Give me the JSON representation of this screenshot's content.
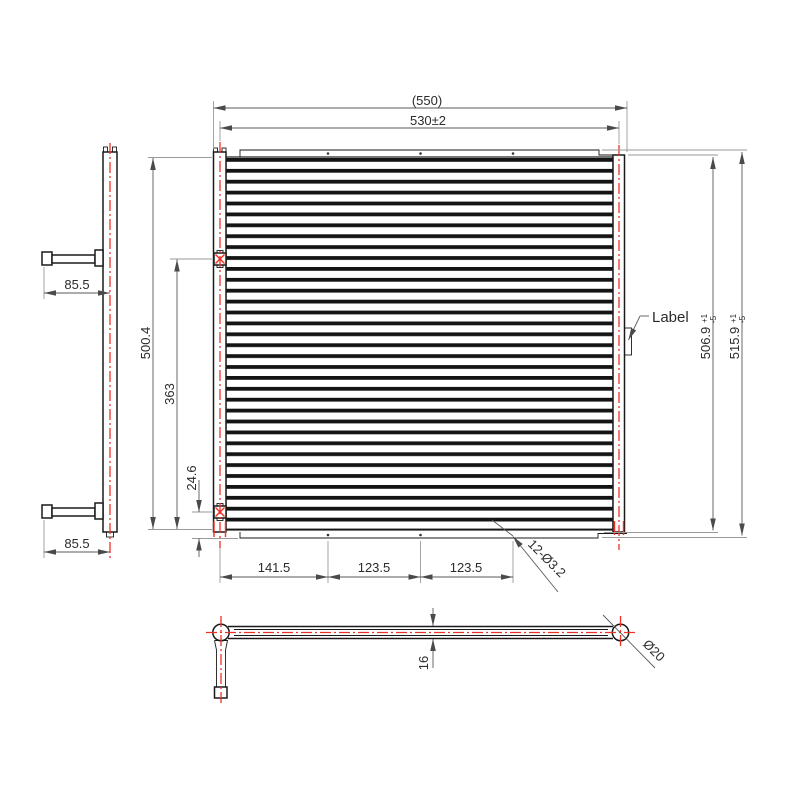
{
  "drawing": {
    "type": "engineering-drawing",
    "subject": "micro-channel condenser coil, three orthographic views",
    "colors": {
      "background": "#ffffff",
      "object_line": "#1a1a1a",
      "dimension_line": "#5a5a5a",
      "extension_line": "#9a9a9a",
      "centerline_red": "#ef3125",
      "text": "#2b2b2b"
    }
  },
  "labels": {
    "overall_width": "(550)",
    "core_width": "530±2",
    "overall_height": "500.4",
    "port_span": "363",
    "port_offset": "24.6",
    "pipe_top": "85.5",
    "pipe_bottom": "85.5",
    "label_callout": "Label",
    "height_inner": {
      "value": "506.9",
      "tol_up": "+1",
      "tol_dn": "-5"
    },
    "height_outer": {
      "value": "515.9",
      "tol_up": "+1",
      "tol_dn": "-5"
    },
    "chain": [
      "141.5",
      "123.5",
      "123.5"
    ],
    "holes_note": "12-Ø3.2",
    "slab_thickness": "16",
    "header_diameter": "Ø20"
  }
}
